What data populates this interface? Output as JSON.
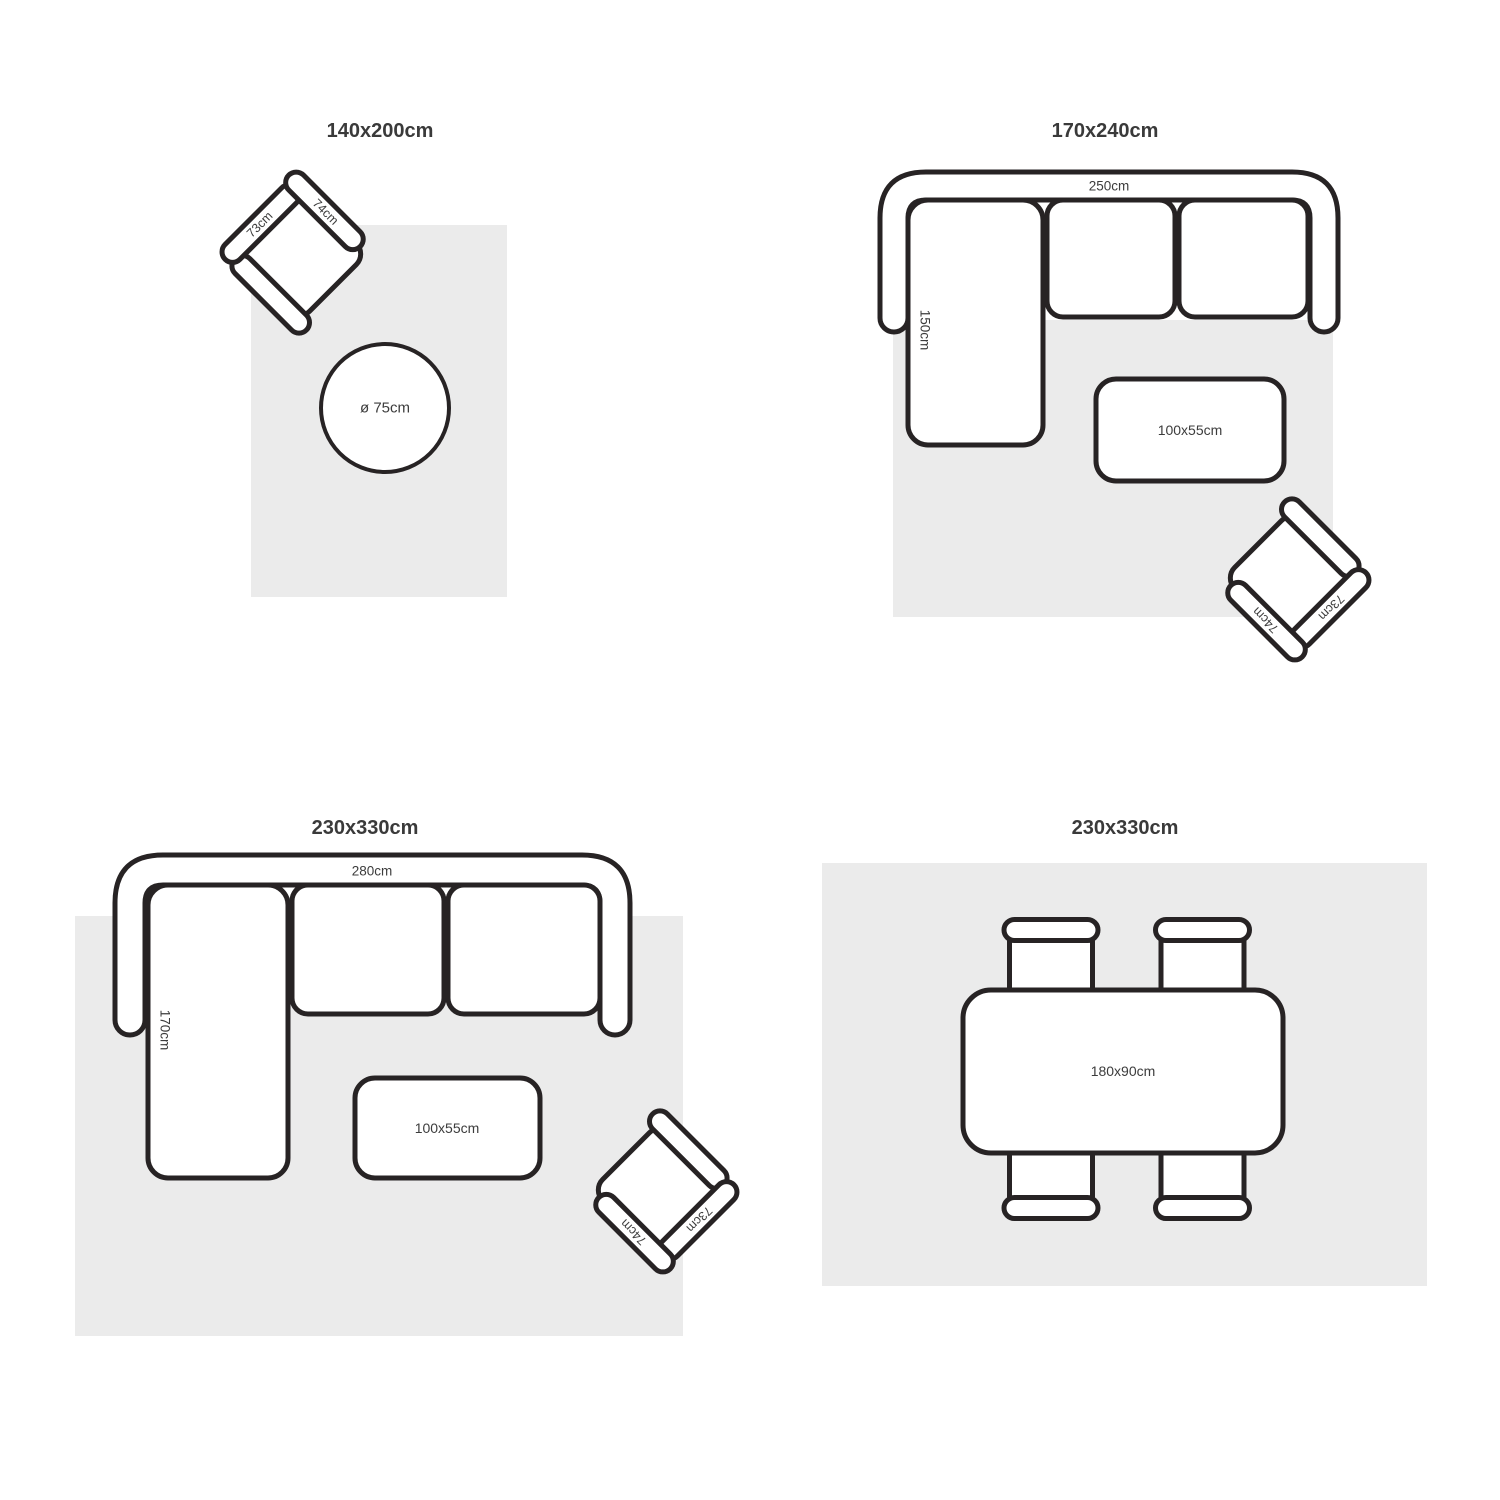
{
  "colors": {
    "background": "#ffffff",
    "rug_fill": "#ebebeb",
    "furniture_fill": "#ffffff",
    "outline_stroke": "#272324",
    "label_text": "#3c3c3c",
    "title_text": "#3a3a3a"
  },
  "armchair": {
    "back_label": "73cm",
    "side_label": "74cm"
  },
  "panels": [
    {
      "title": "140x200cm",
      "round_table_label": "ø 75cm"
    },
    {
      "title": "170x240cm",
      "sofa_width_label": "250cm",
      "sofa_depth_label": "150cm",
      "coffee_table_label": "100x55cm"
    },
    {
      "title": "230x330cm",
      "sofa_width_label": "280cm",
      "sofa_depth_label": "170cm",
      "coffee_table_label": "100x55cm"
    },
    {
      "title": "230x330cm",
      "dining_table_label": "180x90cm"
    }
  ]
}
